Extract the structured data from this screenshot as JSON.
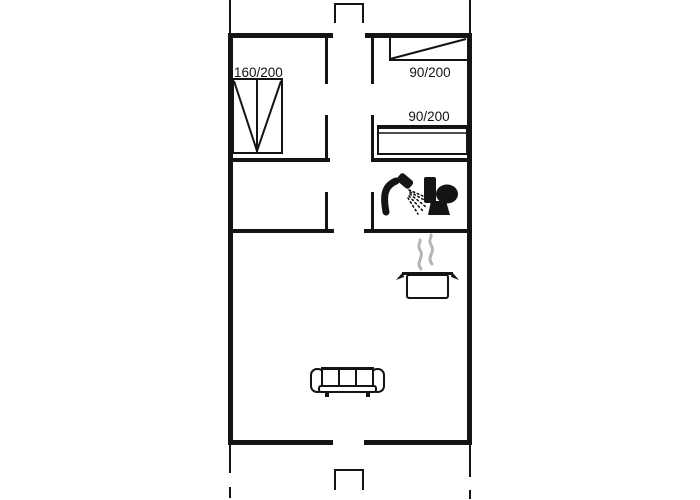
{
  "page": {
    "title": "Holiday home floor plan"
  },
  "colors": {
    "line": "#141414",
    "steam": "#b5b5b5",
    "furniture_fill": "#ffffff",
    "background": "#ffffff"
  },
  "floor_plan": {
    "labels": {
      "double_bed": "160/200",
      "single_bed_top": "90/200",
      "single_bed_right": "90/200"
    },
    "icons": [
      "double-bed-icon",
      "single-bed-icon",
      "single-bed-icon",
      "shower-icon",
      "toilet-icon",
      "steam-icon",
      "cooking-pot-icon",
      "sofa-icon"
    ]
  }
}
